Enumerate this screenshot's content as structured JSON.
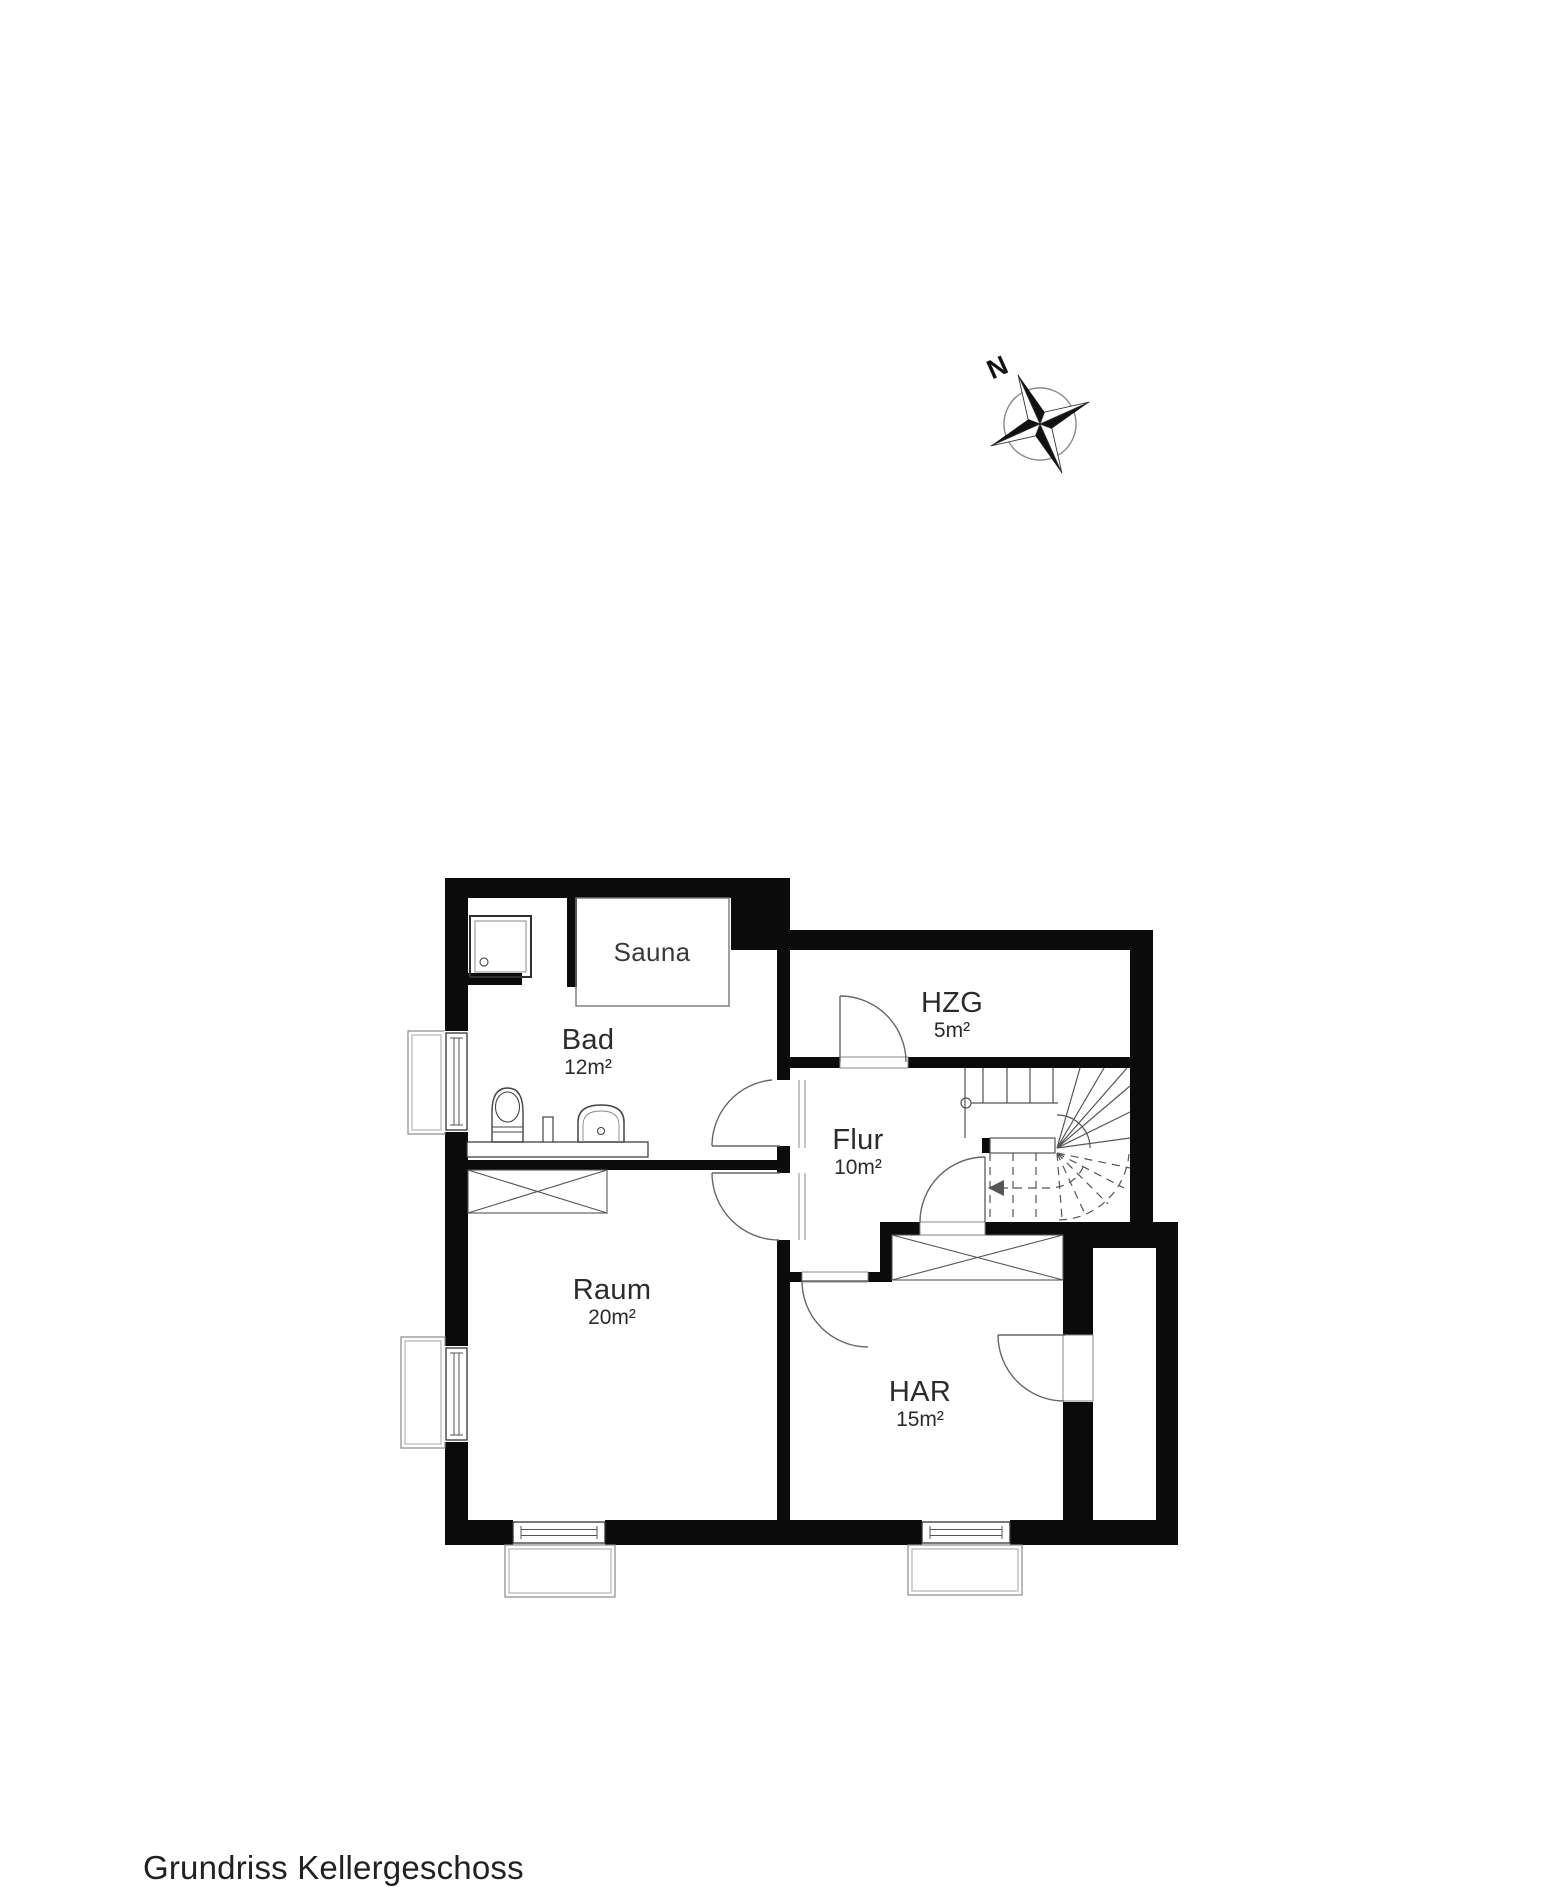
{
  "title": "Grundriss Kellergeschoss",
  "compass": {
    "north_label": "N"
  },
  "rooms": {
    "sauna": {
      "name": "Sauna",
      "area": ""
    },
    "bad": {
      "name": "Bad",
      "area": "12m²"
    },
    "hzg": {
      "name": "HZG",
      "area": "5m²"
    },
    "flur": {
      "name": "Flur",
      "area": "10m²"
    },
    "raum": {
      "name": "Raum",
      "area": "20m²"
    },
    "har": {
      "name": "HAR",
      "area": "15m²"
    }
  },
  "colors": {
    "wall": "#0b0b0b",
    "thin_line": "#555555",
    "text": "#2b2b2b"
  }
}
